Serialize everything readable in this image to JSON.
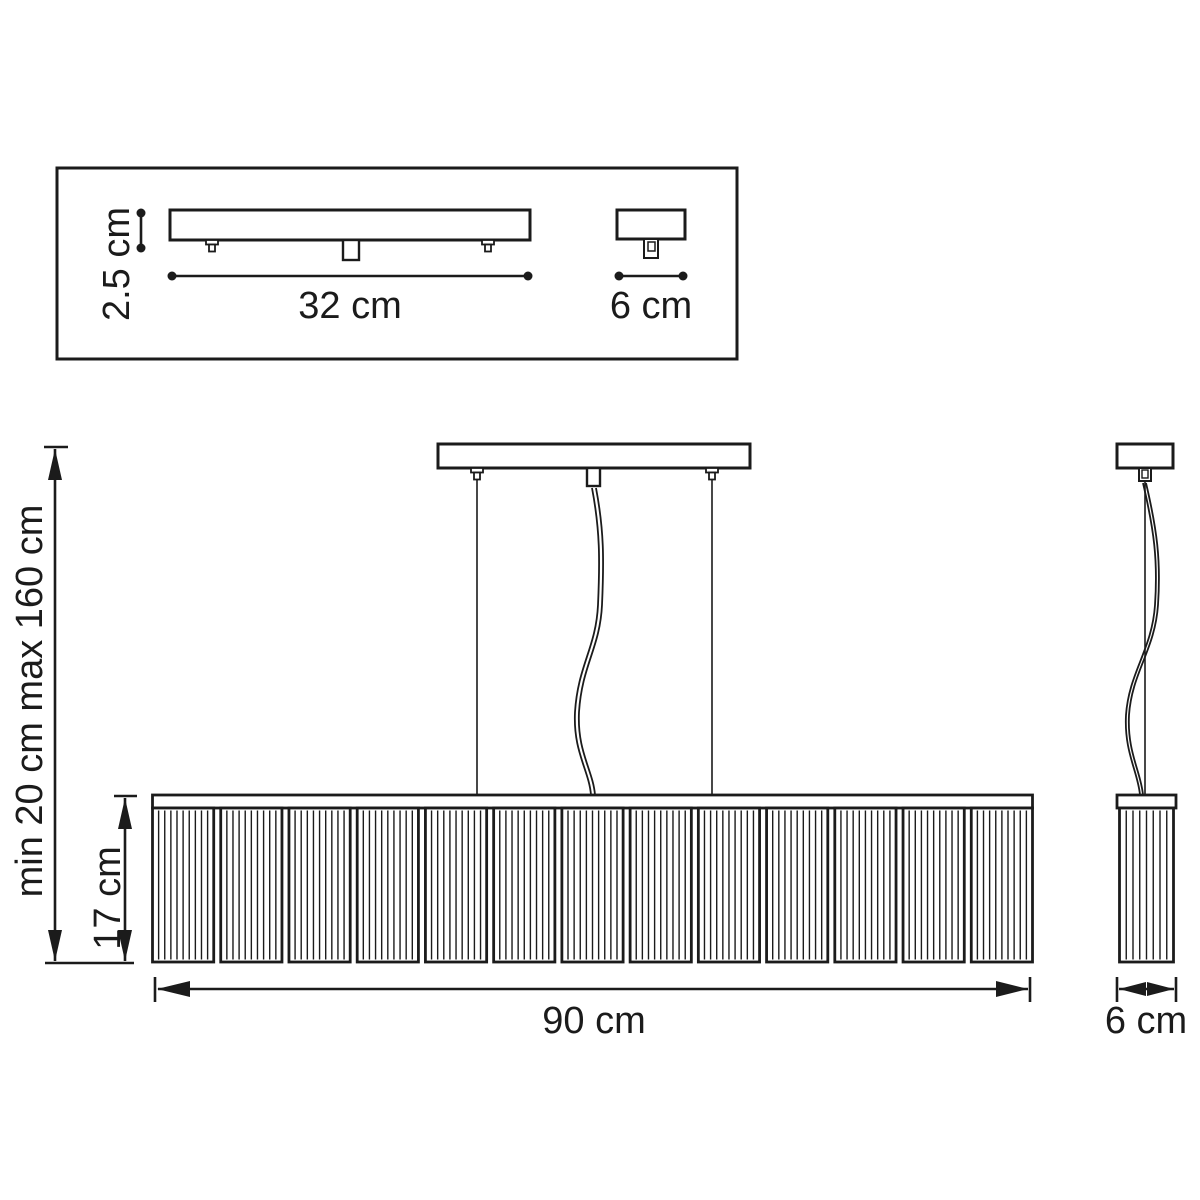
{
  "colors": {
    "ink": "#1b1b1b",
    "paper": "#ffffff"
  },
  "canopy_box": {
    "height_label": "2.5 cm",
    "length_label": "32 cm",
    "depth_label": "6 cm"
  },
  "front_view": {
    "suspension_range_label": "min 20 cm max 160 cm",
    "shade_height_label": "17 cm",
    "width_label": "90 cm"
  },
  "side_view": {
    "depth_label": "6 cm"
  },
  "shade": {
    "panel_count": 13,
    "flutes_per_panel": 10,
    "side_view_flutes": 8
  }
}
